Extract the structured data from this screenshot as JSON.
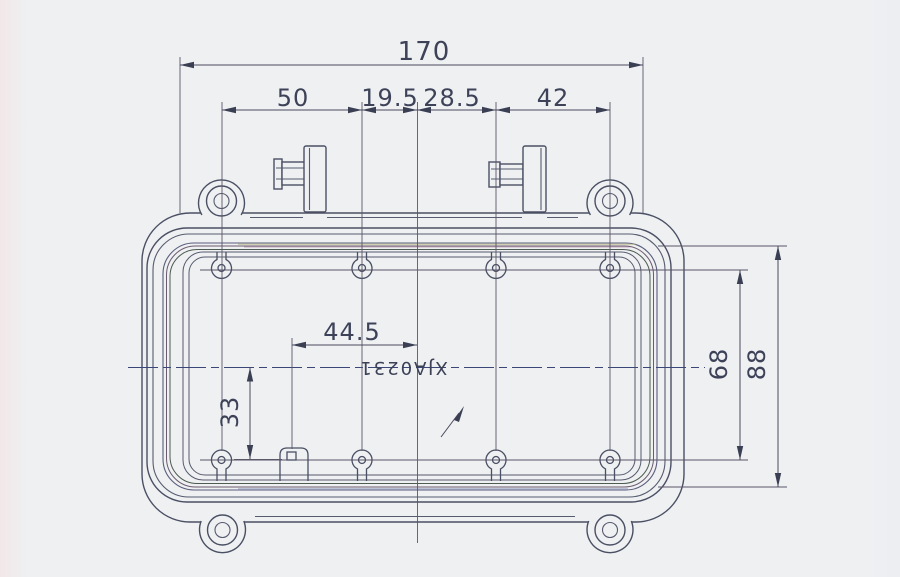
{
  "drawing": {
    "part_number": "XJA0231",
    "dimensions": {
      "overall_width": "170",
      "top_span_1": "50",
      "top_span_2": "19.5",
      "top_span_3": "28.5",
      "top_span_4": "42",
      "inner_offset_x": "44.5",
      "inner_offset_y": "33",
      "boss_row_height": "68",
      "body_height": "88"
    }
  }
}
